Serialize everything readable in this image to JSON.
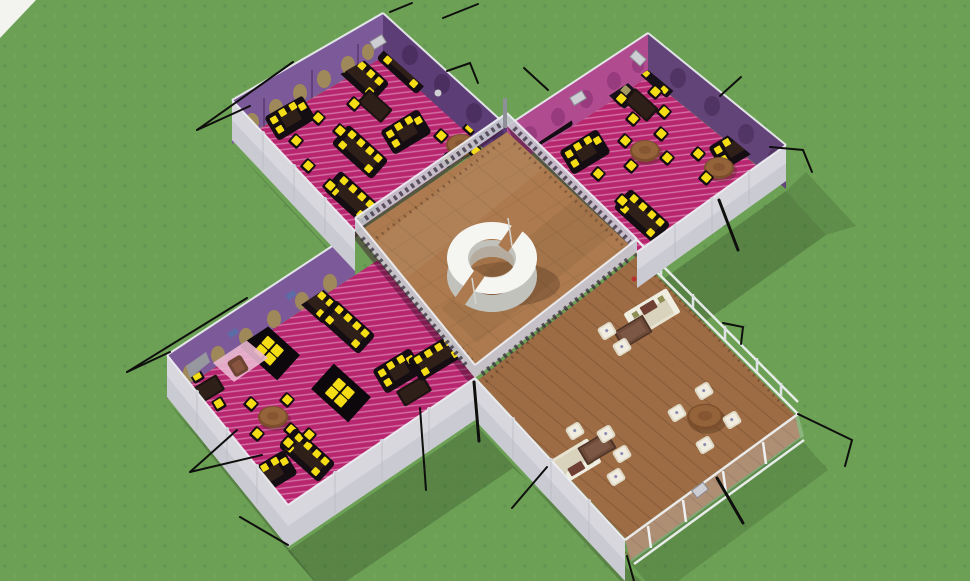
{
  "meta": {
    "title": "3D pavilion model — aerial view",
    "environment": "grass field",
    "view": "isometric aerial three-quarter view"
  },
  "colors": {
    "grass": "#6ca055",
    "grass_dot": "#5e9150",
    "grass_dot2": "#79ab5e",
    "sky": "#f3f3f0",
    "ground_shadow": "#2e4724",
    "pink_floor": "#b8266f",
    "pink_stripe": "#dd8ab8",
    "pink_rug": "#eab8d2",
    "floor_edge": "#3c0f2b",
    "wall_purple": "#7c5a99",
    "wall_purple_dark": "#5c3d75",
    "wall_magenta": "#b04b90",
    "wall_gold": "#a6904e",
    "wall_blue": "#5a6ea8",
    "wall_ridge": "#f0f1f4",
    "wall_white": "#d7d7dd",
    "wall_white_shade": "#bfc0c9",
    "lattice": "#c7c7d0",
    "lattice_dark": "#3c3340",
    "tile_floor": "#ac7a4e",
    "tile_line": "#8f6740",
    "wood_floor": "#9d6c44",
    "wood_line": "#7e5233",
    "ring_top": "#f5f5f2",
    "ring_side": "#c2c2bd",
    "furn_black": "#140d12",
    "furn_inner": "#2e1f19",
    "yellow": "#f5dd16",
    "tan_cushion": "#a39a62",
    "cream": "#e7e2d0",
    "cream_seat": "#d9d3bd",
    "cushion_red": "#6f4033",
    "cushion_olive": "#8e8e55",
    "wood_table": "#6e4a39",
    "round_table": "#95633a",
    "round_table_dark": "#7b4e2c",
    "stool": "#ded8c4",
    "stool_top": "#f0ece0",
    "armchair": "#6e4433",
    "wire": "#0e0e0c",
    "post_gray": "#8f8f97"
  },
  "scene": {
    "ground": {
      "label": "grass lawn"
    },
    "sky": {
      "label": "white horizon corner"
    },
    "building": {
      "label": "cross-shaped five-room pavilion anchored with black guy-wires",
      "wire_count": 18
    },
    "ring": {
      "label": "white circular ring bench, two arc segments with two gaps"
    },
    "rooms": [
      {
        "id": "room-nw",
        "label": "magenta lounge (top left)",
        "floor": "magenta striped carpet",
        "walls": "purple with gold ornate pattern",
        "furniture": [
          "black booth sofas with yellow cushions",
          "dark tables",
          "chairs with yellow seats",
          "round wooden table"
        ]
      },
      {
        "id": "room-ne",
        "label": "magenta lounge (top right)",
        "floor": "magenta striped carpet",
        "walls": "magenta and purple patterned",
        "furniture": [
          "black sofas with tan cushions",
          "corner booths",
          "round wooden tables",
          "chairs with yellow seats"
        ]
      },
      {
        "id": "room-sw",
        "label": "magenta lounge (middle left)",
        "floor": "magenta striped carpet",
        "walls": "purple with gold and blue pattern",
        "furniture": [
          "booths",
          "black floor mats with yellow cushions",
          "round wooden table",
          "pink rug",
          "brown armchair"
        ]
      },
      {
        "id": "room-center",
        "label": "central hall",
        "floor": "tan tile",
        "walls": "low glass lattice railings",
        "furniture": [
          "white circular ring bench"
        ]
      },
      {
        "id": "room-se",
        "label": "wood-floor lounge (bottom right)",
        "floor": "brown wood planks",
        "walls": "white panels and glass railings",
        "furniture": [
          "cream sofas",
          "dark wood coffee tables",
          "white cube stools",
          "round pedestal table"
        ]
      }
    ]
  }
}
